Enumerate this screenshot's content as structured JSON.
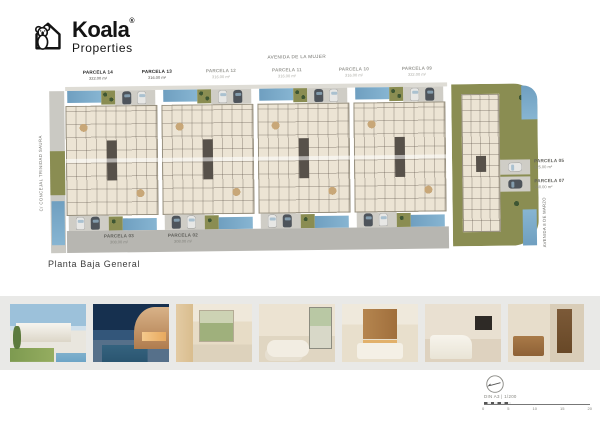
{
  "logo": {
    "brand": "Koala",
    "registered": "®",
    "subtitle": "Properties"
  },
  "plan": {
    "title": "Planta Baja General",
    "streets": {
      "top": "AVENIDA DE LA MUJER",
      "left": "C/ CONCEJAL TRINIDAD SAURA",
      "right": "AVENIDA 8 DE MARZO"
    },
    "parcels_top": [
      {
        "name": "PARCELA 14",
        "area": "322.00 m²"
      },
      {
        "name": "PARCELA 13",
        "area": "316.00 m²"
      },
      {
        "name": "PARCELA 12",
        "area": "316.00 m²"
      },
      {
        "name": "PARCELA 11",
        "area": "316.00 m²"
      },
      {
        "name": "PARCELA 10",
        "area": "316.00 m²"
      },
      {
        "name": "PARCELA 09",
        "area": "322.00 m²"
      }
    ],
    "parcels_bottom": [
      {
        "name": "PARCELA 03",
        "area": "308.00 m²"
      },
      {
        "name": "PARCELA 02",
        "area": "308.00 m²"
      }
    ],
    "parcels_right": [
      {
        "name": "PARCELA 05",
        "area": "325.00 m²"
      },
      {
        "name": "PARCELA 07",
        "area": "340.00 m²"
      }
    ]
  },
  "photos": [
    "exterior-day",
    "exterior-dusk",
    "interior-terrace",
    "living-room",
    "kitchen-dining",
    "bedroom",
    "bathroom-hall"
  ],
  "footer": {
    "scale_text": "DIN A3 | 1/200",
    "scale_ticks": [
      "0",
      "5",
      "10",
      "15",
      "20"
    ]
  },
  "colors": {
    "pool": "#7aa9c7",
    "lawn": "#8a8d52",
    "road": "#b7b6b1",
    "building": "#ece4d4",
    "band": "#e9e9e7",
    "brand_dark": "#141414"
  }
}
